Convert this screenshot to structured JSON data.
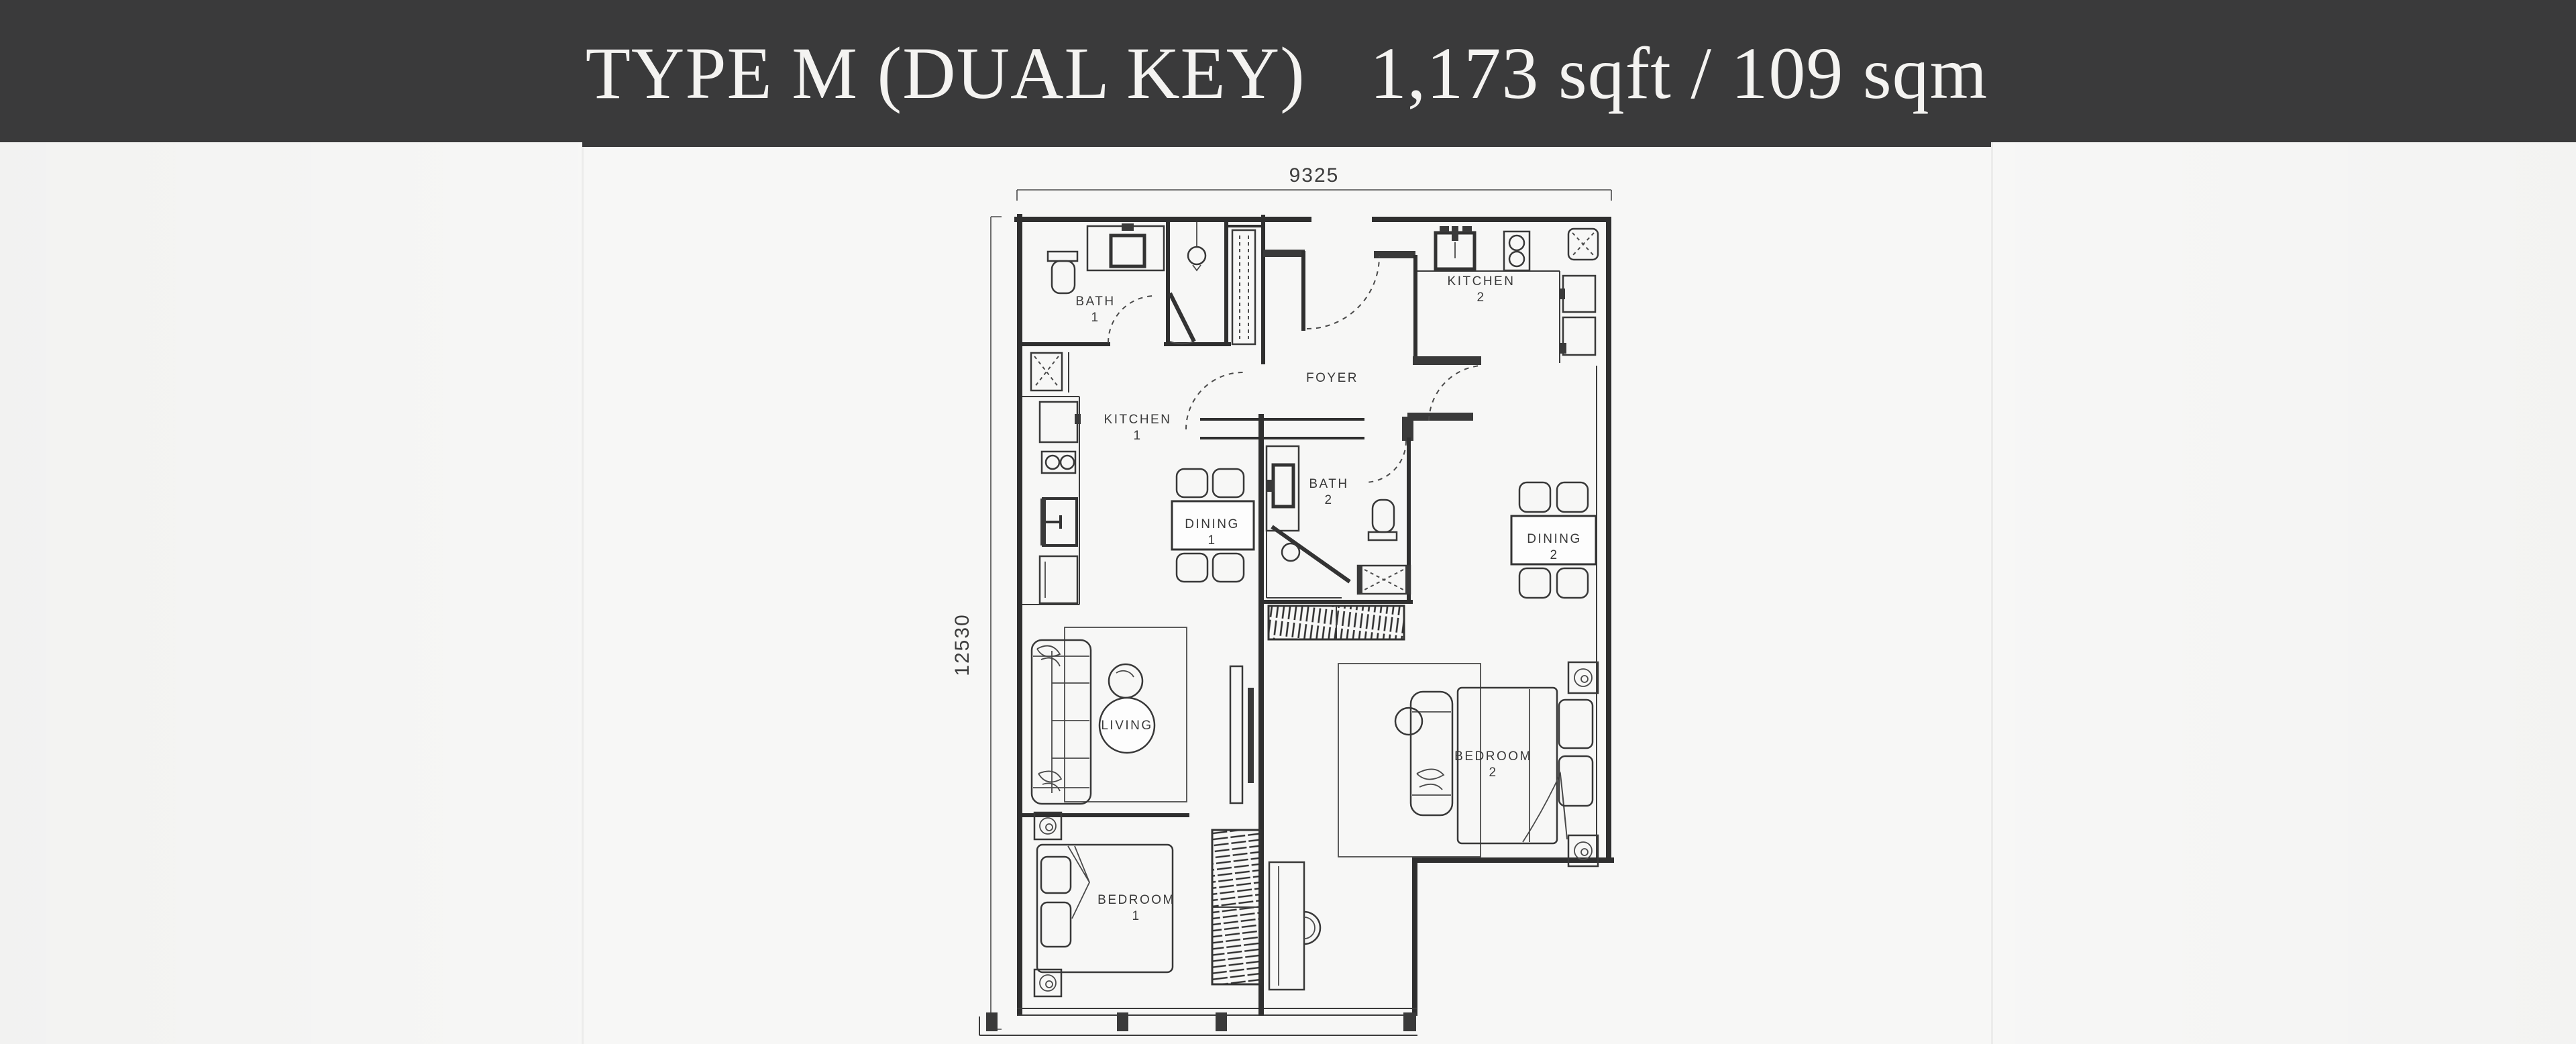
{
  "header": {
    "title": "TYPE M (DUAL KEY)",
    "area": "1,173 sqft / 109 sqm"
  },
  "dimensions": {
    "width": "9325",
    "depth": "12530"
  },
  "rooms": {
    "bath1": {
      "name": "BATH",
      "number": "1"
    },
    "kitchen1": {
      "name": "KITCHEN",
      "number": "1"
    },
    "kitchen2": {
      "name": "KITCHEN",
      "number": "2"
    },
    "foyer": {
      "name": "FOYER"
    },
    "bath2": {
      "name": "BATH",
      "number": "2"
    },
    "dining1": {
      "name": "DINING",
      "number": "1"
    },
    "dining2": {
      "name": "DINING",
      "number": "2"
    },
    "living": {
      "name": "LIVING"
    },
    "bedroom1": {
      "name": "BEDROOM",
      "number": "1"
    },
    "bedroom2": {
      "name": "BEDROOM",
      "number": "2"
    }
  },
  "colors": {
    "header_bg": "#3a3a3b",
    "header_text": "#f4f3f1",
    "plan_line": "#2f2f2f",
    "page_bg": "#f7f7f6"
  }
}
